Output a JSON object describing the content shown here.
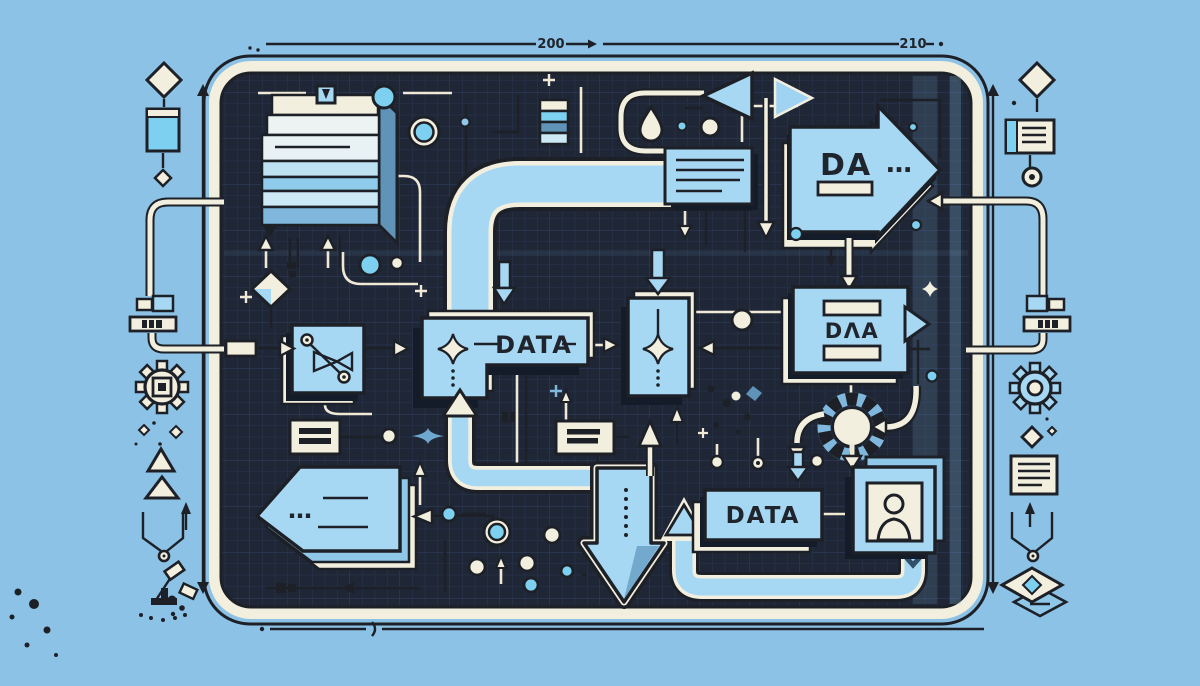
{
  "palette": {
    "background": "#8CC2E6",
    "board": "#1F2737",
    "board_grid": "#2B3A58",
    "frame_cream": "#F3EFDF",
    "shape_blue": "#A6D7F3",
    "bright_blue": "#7ED0F0",
    "mid_blue": "#7FB8DC",
    "deep_blue": "#5F93B8",
    "outline": "#1D2026",
    "shadow_navy": "#141B29"
  },
  "labels": {
    "center_box": "DATA",
    "flow_arrow": "DA",
    "flow_arrow_ellipsis": "…",
    "right_box": "DΛA",
    "bottom_box": "DATA",
    "tag_ellipsis": "…",
    "dim_left": "200",
    "dim_right": "210"
  },
  "margin_icons": {
    "left": [
      "diamond",
      "blue-card",
      "small-diamond",
      "plug-connector",
      "gear-outline",
      "sparkles",
      "triangle-pair",
      "up-arrow",
      "chevron-flow",
      "desk-lamp"
    ],
    "right": [
      "diamond",
      "note-card",
      "target",
      "plug-connector",
      "gear-blue",
      "diamond-sparkle",
      "document-lines",
      "up-arrow",
      "chevron-flow",
      "layered-diamond"
    ]
  },
  "board_icons": [
    "layer-stack",
    "cube",
    "bars-stack",
    "water-drop",
    "triangle-left",
    "triangle-right",
    "note-box",
    "flow-arrow-right",
    "valve-node",
    "decision-diamond",
    "process-card-tall",
    "data-box-l",
    "equals-card",
    "tag-arrow-left",
    "big-down-arrow",
    "loop-gear-node",
    "person-card",
    "data-box-bottom",
    "dots-cluster"
  ]
}
